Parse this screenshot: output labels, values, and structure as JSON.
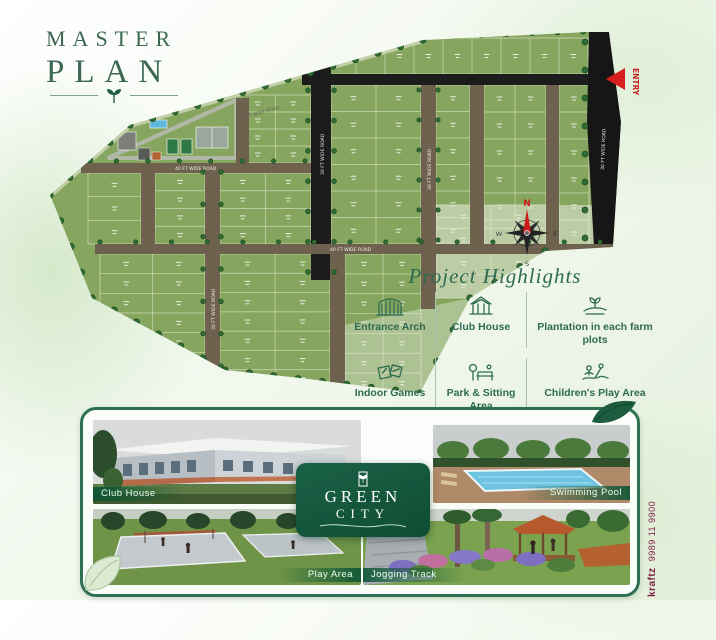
{
  "title": {
    "line1": "MASTER",
    "line2": "PLAN"
  },
  "map": {
    "road_label_vertical": "30 FT WIDE ROAD",
    "road_label_horizontal": "40 FT WIDE ROAD",
    "entry_label": "ENTRY",
    "compass": {
      "n": "N",
      "e": "E",
      "s": "S",
      "w": "W"
    }
  },
  "highlights": {
    "heading": "Project Highlights",
    "items": [
      {
        "label": "Entrance Arch"
      },
      {
        "label": "Club House"
      },
      {
        "label": "Plantation in each farm plots"
      },
      {
        "label": "Indoor Games"
      },
      {
        "label": "Park & Sitting Area"
      },
      {
        "label": "Children's Play Area"
      }
    ]
  },
  "gallery": {
    "photos": [
      {
        "label": "Club House"
      },
      {
        "label": "Swimming Pool"
      },
      {
        "label": "Play Area"
      },
      {
        "label": "Jogging Track"
      }
    ],
    "logo": {
      "line1": "GREEN",
      "line2": "CITY"
    }
  },
  "footer": {
    "brand": "kraftz",
    "phone": "9989 11 9900"
  },
  "colors": {
    "accent_green": "#2e6b50",
    "plot_green": "#86a65f",
    "road_black": "#1c1c1c",
    "road_brown": "#6e614e",
    "badge_green": "#12573c",
    "entry_red": "#d81f1f",
    "credit_maroon": "#7d1c45"
  }
}
